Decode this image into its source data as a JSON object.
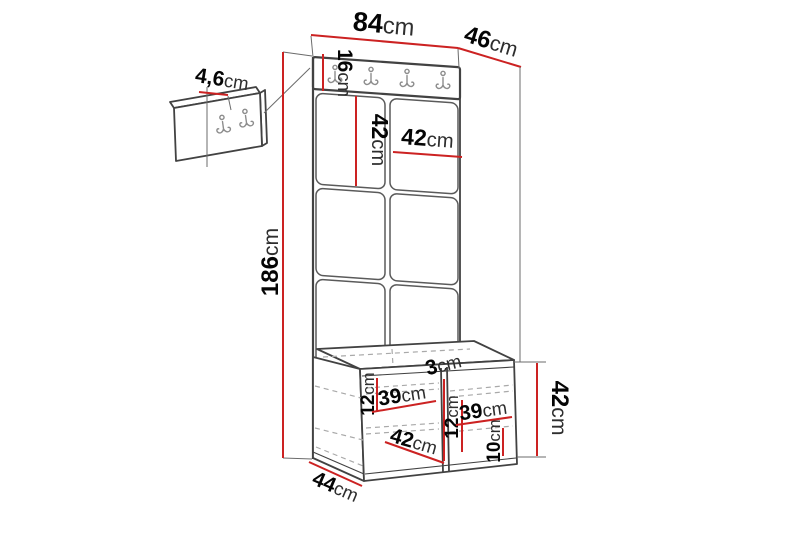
{
  "diagram": {
    "type": "furniture-dimension-diagram",
    "subject": "hallway set: upholstered panel wall unit with hook rail, shoe bench and separate small hook panel",
    "units": "cm",
    "rail_hook_count": 4,
    "small_panel_hook_count": 2
  },
  "colors": {
    "dimension_line": "#cc2222",
    "outline": "#424242",
    "hidden_line": "#a9a9a9",
    "extension_line": "#6b6b6b",
    "hook_color": "#8d8d8d",
    "background": "#ffffff"
  },
  "dimensions": {
    "width_total": {
      "value": "84",
      "unit": "cm"
    },
    "depth_total": {
      "value": "46",
      "unit": "cm"
    },
    "small_panel_thickness": {
      "value": "4,6",
      "unit": "cm"
    },
    "rail_height": {
      "value": "16",
      "unit": "cm"
    },
    "tile_height": {
      "value": "42",
      "unit": "cm"
    },
    "tile_width": {
      "value": "42",
      "unit": "cm"
    },
    "height_total": {
      "value": "186",
      "unit": "cm"
    },
    "bench_top_gap_left": {
      "value": "12",
      "unit": "cm"
    },
    "bench_shelf_left": {
      "value": "39",
      "unit": "cm"
    },
    "divider_thickness": {
      "value": "3",
      "unit": "cm"
    },
    "bench_top_gap_right": {
      "value": "12",
      "unit": "cm"
    },
    "bench_shelf_right": {
      "value": "39",
      "unit": "cm"
    },
    "bench_inner_width": {
      "value": "42",
      "unit": "cm"
    },
    "plinth_height": {
      "value": "10",
      "unit": "cm"
    },
    "bench_height": {
      "value": "42",
      "unit": "cm"
    },
    "bench_depth": {
      "value": "44",
      "unit": "cm"
    }
  }
}
